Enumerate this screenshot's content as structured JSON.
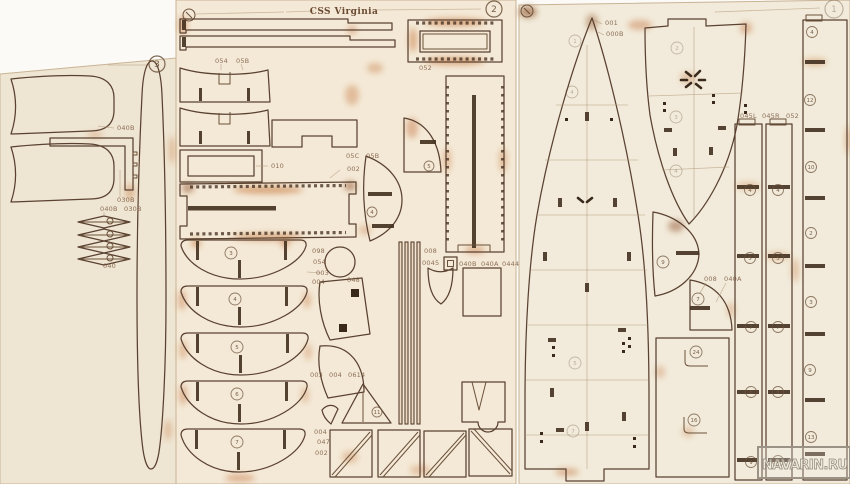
{
  "scene": {
    "title": "CSS Virginia",
    "watermark": "NAVARIN.RU"
  },
  "colors": {
    "wood_left": "#efe5d3",
    "wood_mid": "#f4e9d7",
    "wood_right": "#f2ebdb",
    "cut_line": "#5a4130",
    "burn": "#c06a2c",
    "label": "#7a5a40"
  },
  "sheets": [
    {
      "name": "spar-sheet",
      "number": "3"
    },
    {
      "name": "frames-sheet",
      "number": "2"
    },
    {
      "name": "deck-sheet",
      "number": "1"
    }
  ],
  "part_labels": [
    {
      "t": "040B",
      "x": 117,
      "y": 130
    },
    {
      "t": "030B",
      "x": 117,
      "y": 202
    },
    {
      "t": "040B",
      "x": 100,
      "y": 211
    },
    {
      "t": "030B",
      "x": 124,
      "y": 211
    },
    {
      "t": "040",
      "x": 103,
      "y": 268
    },
    {
      "t": "054",
      "x": 215,
      "y": 63
    },
    {
      "t": "05B",
      "x": 236,
      "y": 63
    },
    {
      "t": "052",
      "x": 419,
      "y": 70
    },
    {
      "t": "010",
      "x": 271,
      "y": 168
    },
    {
      "t": "05C",
      "x": 346,
      "y": 158
    },
    {
      "t": "05B",
      "x": 366,
      "y": 158
    },
    {
      "t": "002",
      "x": 347,
      "y": 171
    },
    {
      "t": "098",
      "x": 312,
      "y": 253
    },
    {
      "t": "054",
      "x": 313,
      "y": 264
    },
    {
      "t": "003",
      "x": 316,
      "y": 275
    },
    {
      "t": "004",
      "x": 312,
      "y": 284
    },
    {
      "t": "048",
      "x": 347,
      "y": 282
    },
    {
      "t": "003",
      "x": 310,
      "y": 377
    },
    {
      "t": "004",
      "x": 329,
      "y": 377
    },
    {
      "t": "0614",
      "x": 348,
      "y": 377
    },
    {
      "t": "004",
      "x": 314,
      "y": 434
    },
    {
      "t": "047",
      "x": 317,
      "y": 444
    },
    {
      "t": "002",
      "x": 315,
      "y": 455
    },
    {
      "t": "008",
      "x": 424,
      "y": 253
    },
    {
      "t": "0045",
      "x": 422,
      "y": 265
    },
    {
      "t": "040B",
      "x": 459,
      "y": 266
    },
    {
      "t": "040A",
      "x": 481,
      "y": 266
    },
    {
      "t": "0444",
      "x": 502,
      "y": 266
    },
    {
      "t": "001",
      "x": 605,
      "y": 25
    },
    {
      "t": "000B",
      "x": 606,
      "y": 36
    },
    {
      "t": "045L",
      "x": 740,
      "y": 118
    },
    {
      "t": "045R",
      "x": 762,
      "y": 118
    },
    {
      "t": "052",
      "x": 786,
      "y": 118
    },
    {
      "t": "008",
      "x": 704,
      "y": 281
    },
    {
      "t": "040A",
      "x": 724,
      "y": 281
    }
  ],
  "circled_numbers": [
    {
      "t": "3",
      "x": 157,
      "y": 64,
      "r": 8,
      "sheet": true
    },
    {
      "t": "2",
      "x": 494,
      "y": 9,
      "r": 8,
      "sheet": true
    },
    {
      "t": "1",
      "x": 834,
      "y": 9,
      "r": 9,
      "sheet": true,
      "faint": true
    },
    {
      "t": "3",
      "x": 231,
      "y": 253,
      "r": 6
    },
    {
      "t": "4",
      "x": 235,
      "y": 299,
      "r": 6
    },
    {
      "t": "5",
      "x": 237,
      "y": 347,
      "r": 6
    },
    {
      "t": "6",
      "x": 237,
      "y": 394,
      "r": 6
    },
    {
      "t": "7",
      "x": 237,
      "y": 442,
      "r": 6
    },
    {
      "t": "4",
      "x": 372,
      "y": 212,
      "r": 5
    },
    {
      "t": "5",
      "x": 429,
      "y": 166,
      "r": 5
    },
    {
      "t": "11",
      "x": 377,
      "y": 412,
      "r": 5
    },
    {
      "t": "1",
      "x": 575,
      "y": 41,
      "r": 6,
      "faint": true
    },
    {
      "t": "4",
      "x": 572,
      "y": 92,
      "r": 6,
      "faint": true
    },
    {
      "t": "5",
      "x": 575,
      "y": 363,
      "r": 6,
      "faint": true
    },
    {
      "t": "7",
      "x": 573,
      "y": 431,
      "r": 6,
      "faint": true
    },
    {
      "t": "2",
      "x": 677,
      "y": 48,
      "r": 6,
      "faint": true
    },
    {
      "t": "3",
      "x": 676,
      "y": 117,
      "r": 6,
      "faint": true
    },
    {
      "t": "4",
      "x": 676,
      "y": 171,
      "r": 6,
      "faint": true
    },
    {
      "t": "9",
      "x": 663,
      "y": 262,
      "r": 6
    },
    {
      "t": "7",
      "x": 698,
      "y": 299,
      "r": 6
    },
    {
      "t": "24",
      "x": 696,
      "y": 352,
      "r": 6
    },
    {
      "t": "16",
      "x": 694,
      "y": 420,
      "r": 6
    },
    {
      "t": "4",
      "x": 750,
      "y": 190,
      "r": 5.5
    },
    {
      "t": "5",
      "x": 750,
      "y": 258,
      "r": 5.5
    },
    {
      "t": "7",
      "x": 751,
      "y": 327,
      "r": 5.5
    },
    {
      "t": "8",
      "x": 751,
      "y": 392,
      "r": 5.5
    },
    {
      "t": "9",
      "x": 751,
      "y": 462,
      "r": 5.5
    },
    {
      "t": "4",
      "x": 778,
      "y": 190,
      "r": 5.5
    },
    {
      "t": "5",
      "x": 778,
      "y": 258,
      "r": 5.5
    },
    {
      "t": "7",
      "x": 778,
      "y": 327,
      "r": 5.5
    },
    {
      "t": "8",
      "x": 778,
      "y": 392,
      "r": 5.5
    },
    {
      "t": "9",
      "x": 778,
      "y": 461,
      "r": 5.5
    },
    {
      "t": "4",
      "x": 812,
      "y": 32,
      "r": 5.5
    },
    {
      "t": "12",
      "x": 810,
      "y": 100,
      "r": 5.5
    },
    {
      "t": "10",
      "x": 811,
      "y": 167,
      "r": 5.5
    },
    {
      "t": "2",
      "x": 811,
      "y": 233,
      "r": 5.5
    },
    {
      "t": "3",
      "x": 811,
      "y": 302,
      "r": 5.5
    },
    {
      "t": "9",
      "x": 810,
      "y": 370,
      "r": 5.5
    },
    {
      "t": "13",
      "x": 811,
      "y": 437,
      "r": 5.5
    }
  ]
}
